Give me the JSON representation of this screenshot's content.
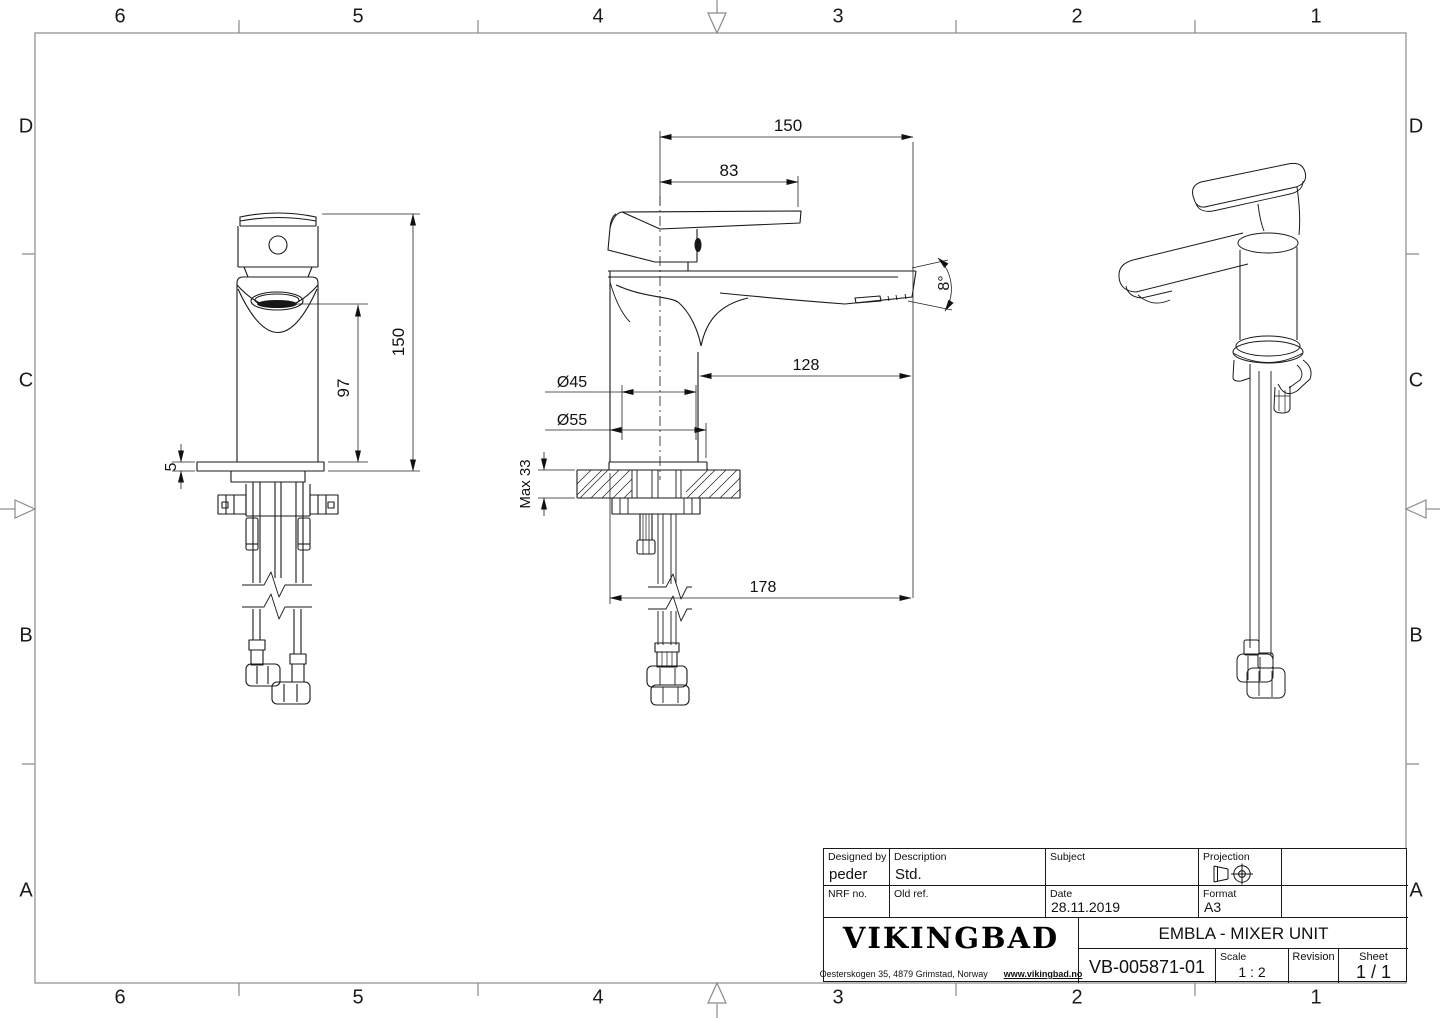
{
  "sheet": {
    "zones": {
      "columns": [
        "6",
        "5",
        "4",
        "3",
        "2",
        "1"
      ],
      "rows": [
        "D",
        "C",
        "B",
        "A"
      ]
    }
  },
  "views": {
    "front": {
      "dim_total_height": "150",
      "dim_aerator_height": "97",
      "dim_base_plate": "5"
    },
    "side": {
      "dim_total_reach": "150",
      "dim_handle_length": "83",
      "dim_spout_angle": "8°",
      "dim_spout_reach": "128",
      "dim_body_dia": "Ø45",
      "dim_base_dia": "Ø55",
      "dim_max_deck": "Max 33",
      "dim_hose_reach": "178"
    }
  },
  "title_block": {
    "designed_by_label": "Designed by",
    "designed_by": "peder",
    "description_label": "Description",
    "description": "Std.",
    "subject_label": "Subject",
    "subject": "",
    "projection_label": "Projection",
    "nrf_label": "NRF no.",
    "nrf": "",
    "old_ref_label": "Old ref.",
    "old_ref": "",
    "date_label": "Date",
    "date": "28.11.2019",
    "format_label": "Format",
    "format": "A3",
    "logo": "VIKINGBAD",
    "address": "Oesterskogen 35, 4879 Grimstad, Norway",
    "website": "www.vikingbad.no",
    "title": "EMBLA - MIXER UNIT",
    "drawing_number": "VB-005871-01",
    "scale_label": "Scale",
    "scale": "1 : 2",
    "revision_label": "Revision",
    "revision": "",
    "sheet_label": "Sheet",
    "sheet": "1 / 1"
  }
}
